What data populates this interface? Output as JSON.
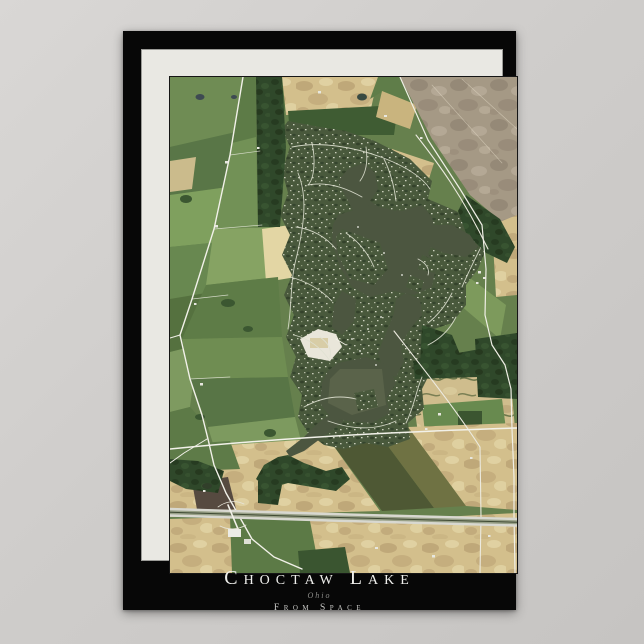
{
  "poster": {
    "title": "Choctaw Lake",
    "subtitle": "Ohio",
    "tagline": "From Space",
    "colors": {
      "page_bg": "#cfcdcb",
      "poster_bg": "#070707",
      "mat": "#e9e8e3",
      "title": "#efefec",
      "subtitle": "#8d8d8a",
      "tagline": "#c9c9c6"
    }
  },
  "map": {
    "description": "satellite view of Choctaw Lake, Ohio",
    "viewbox": "0 0 347 496",
    "palette": {
      "base_green": "#66804d",
      "water": "#4c5640",
      "water_light": "#616a4e",
      "forest": "#2f482a",
      "residential": "#49593c",
      "field_tan": "#d3bf8c",
      "field_gray": "#a59985",
      "field_pale": "#e3d6a4",
      "plowed_olive": "#4e5834",
      "plowed_brown": "#564a40",
      "road": "#f2f1e9",
      "highway_lane": "#d8d8d0",
      "highway_casing": "#98a087",
      "sand": "#e9e6da"
    },
    "layers": [
      {
        "t": "poly",
        "p": "0,0 347,0 347,496 0,496",
        "f": "#66804d"
      },
      {
        "t": "poly",
        "p": "0,0 73,0 66,55 0,70",
        "f": "#6f8c54"
      },
      {
        "t": "poly",
        "p": "0,70 66,55 58,110 0,118",
        "f": "#597647"
      },
      {
        "t": "poly",
        "p": "0,118 58,110 50,165 0,170",
        "f": "#7fa05e"
      },
      {
        "t": "poly",
        "p": "0,170 50,165 42,215 0,222",
        "f": "#688850"
      },
      {
        "t": "poly",
        "p": "0,222 42,215 30,268 0,275",
        "f": "#55713f"
      },
      {
        "t": "poly",
        "p": "0,84 26,80 22,112 0,115",
        "f": "#cbbb8c"
      },
      {
        "t": "poly",
        "p": "0,275 28,268 20,330 0,335",
        "f": "#7e9a60"
      },
      {
        "t": "poly",
        "p": "0,335 20,330 38,350 30,382 0,382",
        "f": "#5d7a47"
      },
      {
        "t": "poly",
        "p": "73,0 86,0 86,62 62,66",
        "f": "#5d7b47"
      },
      {
        "t": "poly",
        "p": "62,66 86,60 88,150 44,152",
        "f": "#729156"
      },
      {
        "t": "poly",
        "p": "44,152 112,150 108,200 36,208",
        "f": "#86a363"
      },
      {
        "t": "poly",
        "p": "92,152 120,148 126,200 96,205",
        "f": "#e3d6a4"
      },
      {
        "t": "poly",
        "p": "36,208 108,200 112,260 12,262",
        "f": "#5e7c47"
      },
      {
        "t": "poly",
        "p": "12,262 112,260 118,300 20,302",
        "f": "#6f8d52"
      },
      {
        "t": "poly",
        "p": "20,302 118,300 125,340 38,350",
        "f": "#587546"
      },
      {
        "t": "poly",
        "p": "38,350 125,340 132,368 55,392 44,370",
        "f": "#7d9a5f"
      },
      {
        "t": "poly",
        "p": "86,0 115,0 118,34 88,36",
        "f": "#54703f"
      },
      {
        "t": "poly",
        "p": "112,0 208,0 200,36 116,38",
        "f": "url(#p-tan)"
      },
      {
        "t": "poly",
        "p": "118,34 228,28 224,58 120,58",
        "f": "#3f5c33"
      },
      {
        "t": "poly",
        "p": "208,0 232,0 247,28 210,16 200,22",
        "f": "#5f7d49"
      },
      {
        "t": "poly",
        "p": "212,14 247,28 240,52 206,40",
        "f": "#c9b47e"
      },
      {
        "t": "poly",
        "p": "230,0 347,0 347,62 262,62",
        "f": "url(#p-gray)"
      },
      {
        "t": "poly",
        "p": "262,62 347,60 347,158 300,118",
        "f": "url(#p-gray)"
      },
      {
        "t": "poly",
        "p": "222,72 264,86 250,130 210,112",
        "f": "url(#p-tan)"
      },
      {
        "t": "poly",
        "p": "322,148 347,138 347,218 326,220",
        "f": "url(#p-tan)"
      },
      {
        "t": "poly",
        "p": "296,198 336,228 330,262 290,228",
        "f": "#7d9a5c"
      },
      {
        "t": "poly",
        "p": "240,300 340,292 345,352 248,356",
        "f": "url(#p-tanhedge)"
      },
      {
        "t": "poly",
        "p": "252,328 332,322 336,352 255,356",
        "f": "#688a4f"
      },
      {
        "t": "rect",
        "x": 288,
        "y": 334,
        "w": 24,
        "h": 14,
        "f": "#3b5530"
      },
      {
        "t": "poly",
        "p": "0,372 158,361 210,434 0,440",
        "f": "url(#p-tan)"
      },
      {
        "t": "poly",
        "p": "0,368 60,364 70,392 20,394 0,392",
        "f": "#5e7b48"
      },
      {
        "t": "poly",
        "p": "158,361 206,353 264,431 212,434",
        "f": "#4e5834"
      },
      {
        "t": "poly",
        "p": "206,353 238,350 296,429 264,431",
        "f": "#6f7243"
      },
      {
        "t": "poly",
        "p": "238,350 347,346 347,433 296,429",
        "f": "url(#p-tan)"
      },
      {
        "t": "poly",
        "p": "22,405 58,400 66,432 28,438",
        "f": "#564a40"
      },
      {
        "t": "poly",
        "p": "0,442 60,440 80,462 62,496 0,496",
        "f": "url(#p-tan)"
      },
      {
        "t": "poly",
        "p": "60,440 140,444 150,496 62,496",
        "f": "#5c7a46"
      },
      {
        "t": "poly",
        "p": "140,444 205,442 208,496 150,496",
        "f": "url(#p-tan)"
      },
      {
        "t": "poly",
        "p": "200,444 347,436 347,496 208,496",
        "f": "url(#p-tan)"
      },
      {
        "t": "poly",
        "p": "128,474 175,470 180,496 130,496",
        "f": "#3a5530"
      },
      {
        "t": "poly",
        "p": "118,44 150,50 176,54 205,64 240,82 262,104 258,122 286,134 312,150 316,172 308,192 296,208 296,228 282,246 264,252 258,272 262,292 252,312 254,332 238,346 240,362 218,370 196,366 174,372 154,368 138,356 128,340 132,318 120,300 126,280 116,260 124,238 114,218 122,198 112,178 120,158 110,138 118,116 112,94 120,70 112,52",
        "f": "url(#p-resid)"
      },
      {
        "t": "poly",
        "p": "86,0 112,0 116,70 110,150 88,150",
        "f": "url(#p-forest)"
      },
      {
        "t": "poly",
        "p": "296,118 330,142 345,170 337,186 316,176 296,156 288,134",
        "f": "url(#p-forest)"
      },
      {
        "t": "poly",
        "p": "252,248 282,258 292,282 270,302 250,288",
        "f": "url(#p-forest)"
      },
      {
        "t": "poly",
        "p": "243,284 310,272 308,300 245,302",
        "f": "url(#p-forest)"
      },
      {
        "t": "poly",
        "p": "305,262 347,256 347,322 308,320",
        "f": "url(#p-forest)"
      },
      {
        "t": "poly",
        "p": "118,378 134,386 156,394 172,390 180,402 166,414 142,410 118,406 98,412 86,402 94,388 108,380",
        "f": "url(#p-forest)"
      },
      {
        "t": "poly",
        "p": "88,404 112,408 108,428 88,426",
        "f": "url(#p-forest)"
      },
      {
        "t": "poly",
        "p": "0,382 28,384 54,394 48,416 16,412 0,404",
        "f": "url(#p-forest)"
      },
      {
        "t": "ellipse",
        "cx": 16,
        "cy": 122,
        "rx": 6,
        "ry": 4,
        "f": "#3b5731"
      },
      {
        "t": "ellipse",
        "cx": 58,
        "cy": 226,
        "rx": 7,
        "ry": 4,
        "f": "#3b5731"
      },
      {
        "t": "ellipse",
        "cx": 78,
        "cy": 252,
        "rx": 5,
        "ry": 3,
        "f": "#3b5731"
      },
      {
        "t": "ellipse",
        "cx": 100,
        "cy": 356,
        "rx": 6,
        "ry": 4,
        "f": "#3b5731"
      },
      {
        "t": "ellipse",
        "cx": 30,
        "cy": 340,
        "rx": 5,
        "ry": 3,
        "f": "#3b5731"
      },
      {
        "t": "ellipse",
        "cx": 30,
        "cy": 20,
        "rx": 4.5,
        "ry": 3,
        "f": "#3e4a52"
      },
      {
        "t": "ellipse",
        "cx": 64,
        "cy": 20,
        "rx": 3,
        "ry": 2,
        "f": "#3e4a52"
      },
      {
        "t": "ellipse",
        "cx": 192,
        "cy": 20,
        "rx": 5,
        "ry": 3.5,
        "f": "#394a42"
      },
      {
        "t": "ellipse",
        "cx": 37,
        "cy": 409,
        "rx": 5,
        "ry": 3,
        "f": "#313f2a"
      },
      {
        "t": "poly",
        "p": "178,92 194,86 205,96 208,112 200,124 212,132 200,142 184,136 176,120 168,104",
        "f": "#4c5640"
      },
      {
        "t": "poly",
        "p": "168,138 200,128 232,134 252,128 262,140 266,160 258,176 266,190 262,210 244,218 224,214 200,220 182,210 170,190 162,165 163,148",
        "f": "#4c5640"
      },
      {
        "t": "poly",
        "p": "258,148 282,148 300,158 308,170 296,180 274,176 256,168",
        "f": "#4c5640"
      },
      {
        "t": "poly",
        "p": "236,216 250,222 252,238 240,252 230,268 234,284 226,300 214,296 208,276 216,256 224,236 226,222",
        "f": "#4c5640"
      },
      {
        "t": "poly",
        "p": "168,286 196,280 218,288 226,306 216,322 220,336 202,346 178,344 160,340 150,326 152,306 158,294",
        "f": "#4c5640"
      },
      {
        "t": "poly",
        "p": "172,214 186,222 184,244 172,258 162,250 164,228",
        "f": "#4c5640"
      },
      {
        "t": "poly",
        "p": "160,338 174,344 150,362 134,374 120,380 116,374 134,360 148,346",
        "f": "#4c5640"
      },
      {
        "t": "poly",
        "p": "170,292 212,292 216,328 182,338 158,326 160,302",
        "f": "#616a4e",
        "o": 0.7
      },
      {
        "t": "poly",
        "p": "172,152 210,166 218,192 204,208 180,202 168,178 166,160",
        "f": "url(#p-resid)"
      },
      {
        "t": "poly",
        "p": "210,112 228,120 226,134 210,130",
        "f": "url(#p-resid)"
      },
      {
        "t": "poly",
        "p": "252,178 268,184 264,196 248,192",
        "f": "url(#p-resid)"
      },
      {
        "t": "poly",
        "p": "240,198 254,204 250,216 236,210",
        "f": "url(#p-resid)"
      },
      {
        "t": "poly",
        "p": "184,316 204,312 208,330 188,334",
        "f": "url(#p-resid)"
      },
      {
        "t": "poly",
        "p": "130,262 148,252 166,257 172,270 160,284 138,280",
        "f": "#e9e6da"
      },
      {
        "t": "rect",
        "x": 140,
        "y": 261,
        "w": 18,
        "h": 10,
        "f": "#d8cda6"
      },
      {
        "t": "path",
        "d": "M166,262 L176,268",
        "f": "#f4f2e8",
        "w": 0.8
      },
      {
        "t": "path",
        "d": "M128,96 C138,120 134,150 126,182 C120,206 122,228 118,252",
        "f": "#dfe1d2",
        "w": 0.9,
        "o": 0.9
      },
      {
        "t": "path",
        "d": "M122,70 C150,64 186,70 216,82 C236,90 252,100 260,112",
        "f": "#dfe1d2",
        "w": 0.9,
        "o": 0.9
      },
      {
        "t": "path",
        "d": "M138,108 C158,104 178,112 192,120",
        "f": "#dfe1d2",
        "w": 0.9,
        "o": 0.9
      },
      {
        "t": "path",
        "d": "M126,150 C142,152 156,160 166,172",
        "f": "#dfe1d2",
        "w": 0.9,
        "o": 0.9
      },
      {
        "t": "path",
        "d": "M120,200 C136,204 150,212 162,224",
        "f": "#dfe1d2",
        "w": 0.9,
        "o": 0.9
      },
      {
        "t": "path",
        "d": "M124,258 C140,262 152,272 160,284",
        "f": "#dfe1d2",
        "w": 0.9,
        "o": 0.9
      },
      {
        "t": "path",
        "d": "M134,330 C152,320 170,318 186,322",
        "f": "#dfe1d2",
        "w": 0.9,
        "o": 0.9
      },
      {
        "t": "path",
        "d": "M158,344 C180,352 204,354 226,344",
        "f": "#dfe1d2",
        "w": 0.9,
        "o": 0.9
      },
      {
        "t": "path",
        "d": "M236,346 C244,330 246,314 252,300",
        "f": "#dfe1d2",
        "w": 0.9,
        "o": 0.9
      },
      {
        "t": "path",
        "d": "M258,268 C270,262 280,252 286,240",
        "f": "#dfe1d2",
        "w": 0.9,
        "o": 0.9
      },
      {
        "t": "path",
        "d": "M292,210 C298,196 304,184 310,172",
        "f": "#dfe1d2",
        "w": 0.9,
        "o": 0.9
      },
      {
        "t": "path",
        "d": "M226,124 C224,108 220,94 214,82",
        "f": "#dfe1d2",
        "w": 0.9,
        "o": 0.9
      },
      {
        "t": "path",
        "d": "M176,156 C188,164 198,176 204,190",
        "f": "#dfe1d2",
        "w": 0.9,
        "o": 0.9
      },
      {
        "t": "path",
        "d": "M248,182 C256,186 260,192 258,198",
        "f": "#dfe1d2",
        "w": 0.9,
        "o": 0.9
      },
      {
        "t": "path",
        "d": "M150,260 C158,266 162,272 160,280",
        "f": "#dfe1d2",
        "w": 0.9,
        "o": 0.9
      },
      {
        "t": "path",
        "d": "M142,66 C146,84 144,102 138,108",
        "f": "#dfe1d2",
        "w": 0.9,
        "o": 0.9
      },
      {
        "t": "path",
        "d": "M196,70 C198,84 196,96 190,104",
        "f": "#dfe1d2",
        "w": 0.9,
        "o": 0.9
      },
      {
        "t": "path",
        "d": "M282,216 C276,228 268,238 258,246",
        "f": "#dfe1d2",
        "w": 0.9,
        "o": 0.9
      },
      {
        "t": "path",
        "d": "M246,58 C268,86 292,118 318,172",
        "f": "#eceadf",
        "w": 1.1
      },
      {
        "t": "path",
        "d": "M73,0 L60,78 L44,152 L22,222 L10,258 L20,302 L32,338 L38,362 L44,388 L56,416 L64,430 L82,462 L104,480 L132,492",
        "f": "#f2f1e9",
        "w": 1.4
      },
      {
        "t": "path",
        "d": "M10,258 L0,261",
        "f": "#f2f1e9",
        "w": 1
      },
      {
        "t": "path",
        "d": "M37,362 L14,376 L0,386",
        "f": "#f2f1e9",
        "w": 1
      },
      {
        "t": "path",
        "d": "M230,0 L258,63 L290,112 L312,148 L316,192 L315,238 L322,268 L335,288 L341,312 L342,352 L344,400 L344,438 L345,496",
        "f": "#f0efe6",
        "w": 1.2
      },
      {
        "t": "path",
        "d": "M224,254 C252,290 284,330 310,370 L311,440 L310,496",
        "f": "#eceadf",
        "w": 1.1
      },
      {
        "t": "path",
        "d": "M0,372 C60,366 140,360 220,356 C262,354 310,352 347,351",
        "f": "#f2f1e9",
        "w": 1.5
      },
      {
        "t": "path",
        "d": "M262,8 L332,86",
        "f": "#e3dbc6",
        "w": 0.7,
        "o": 0.55
      },
      {
        "t": "path",
        "d": "M292,2 L347,52",
        "f": "#e3dbc6",
        "w": 0.7,
        "o": 0.55
      },
      {
        "t": "path",
        "d": "M60,78 L90,74",
        "f": "#eeeee4",
        "w": 0.7,
        "o": 0.8
      },
      {
        "t": "path",
        "d": "M44,152 L92,148",
        "f": "#eeeee4",
        "w": 0.7,
        "o": 0.8
      },
      {
        "t": "path",
        "d": "M22,222 L58,218",
        "f": "#eeeee4",
        "w": 0.7,
        "o": 0.8
      },
      {
        "t": "path",
        "d": "M20,302 L60,300",
        "f": "#eeeee4",
        "w": 0.7,
        "o": 0.8
      },
      {
        "t": "path",
        "d": "M0,435 L160,440 L347,445",
        "f": "#98a087",
        "w": 8
      },
      {
        "t": "path",
        "d": "M0,432 L160,437 L347,442",
        "f": "#d8d8d0",
        "w": 2.4
      },
      {
        "t": "path",
        "d": "M0,438.5 L160,443.5 L347,448.5",
        "f": "#d8d8d0",
        "w": 2.4
      },
      {
        "t": "path",
        "d": "M0,435.2 L160,440.2 L347,445.2",
        "f": "#3f4a33",
        "w": 1
      },
      {
        "t": "path",
        "d": "M58,428 L68,452",
        "f": "#f2f1e9",
        "w": 1.6
      },
      {
        "t": "path",
        "d": "M48,430 C56,424 66,423 74,427",
        "f": "#e6e4d8",
        "w": 0.8
      },
      {
        "t": "path",
        "d": "M50,449 C58,453 68,453 76,448",
        "f": "#e6e4d8",
        "w": 0.8
      },
      {
        "t": "rect",
        "x": 58,
        "y": 452,
        "w": 13,
        "h": 8,
        "f": "#ecece6"
      },
      {
        "t": "rect",
        "x": 74,
        "y": 462,
        "w": 7,
        "h": 5,
        "f": "#dedfd6"
      },
      {
        "t": "rect",
        "x": 55,
        "y": 84,
        "w": 3,
        "h": 2.5,
        "f": "#e7e7df"
      },
      {
        "t": "rect",
        "x": 45,
        "y": 148,
        "w": 3,
        "h": 2.5,
        "f": "#e7e7df"
      },
      {
        "t": "rect",
        "x": 87,
        "y": 70,
        "w": 2.5,
        "h": 2,
        "f": "#e7e7df"
      },
      {
        "t": "rect",
        "x": 148,
        "y": 14,
        "w": 3,
        "h": 2.5,
        "f": "#e7e7df"
      },
      {
        "t": "rect",
        "x": 214,
        "y": 38,
        "w": 3,
        "h": 2,
        "f": "#e7e7df"
      },
      {
        "t": "rect",
        "x": 250,
        "y": 60,
        "w": 2.5,
        "h": 2,
        "f": "#e7e7df"
      },
      {
        "t": "rect",
        "x": 308,
        "y": 194,
        "w": 3,
        "h": 2.5,
        "f": "#e7e7df"
      },
      {
        "t": "rect",
        "x": 313,
        "y": 200,
        "w": 2.5,
        "h": 2,
        "f": "#e7e7df"
      },
      {
        "t": "rect",
        "x": 306,
        "y": 205,
        "w": 2.5,
        "h": 2,
        "f": "#e7e7df"
      },
      {
        "t": "rect",
        "x": 268,
        "y": 336,
        "w": 3,
        "h": 2.5,
        "f": "#e7e7df"
      },
      {
        "t": "rect",
        "x": 255,
        "y": 351,
        "w": 2.5,
        "h": 2,
        "f": "#e7e7df"
      },
      {
        "t": "rect",
        "x": 300,
        "y": 380,
        "w": 2.5,
        "h": 2,
        "f": "#e7e7df"
      },
      {
        "t": "rect",
        "x": 33,
        "y": 413,
        "w": 2.5,
        "h": 2,
        "f": "#e7e7df"
      },
      {
        "t": "rect",
        "x": 205,
        "y": 470,
        "w": 3,
        "h": 2,
        "f": "#e7e7df"
      },
      {
        "t": "rect",
        "x": 262,
        "y": 478,
        "w": 3,
        "h": 2.5,
        "f": "#e7e7df"
      },
      {
        "t": "rect",
        "x": 318,
        "y": 458,
        "w": 2.5,
        "h": 2,
        "f": "#e7e7df"
      },
      {
        "t": "rect",
        "x": 30,
        "y": 306,
        "w": 3,
        "h": 2.5,
        "f": "#e7e7df"
      },
      {
        "t": "rect",
        "x": 24,
        "y": 226,
        "w": 2.5,
        "h": 2,
        "f": "#e7e7df"
      },
      {
        "t": "dot",
        "cx": 182,
        "cy": 262,
        "r": 0.9,
        "f": "#f2f2ea"
      },
      {
        "t": "dot",
        "cx": 190,
        "cy": 274,
        "r": 0.9,
        "f": "#f2f2ea"
      },
      {
        "t": "dot",
        "cx": 198,
        "cy": 252,
        "r": 0.9,
        "f": "#f2f2ea"
      },
      {
        "t": "dot",
        "cx": 206,
        "cy": 288,
        "r": 0.9,
        "f": "#f2f2ea"
      },
      {
        "t": "dot",
        "cx": 188,
        "cy": 150,
        "r": 0.9,
        "f": "#f2f2ea"
      },
      {
        "t": "dot",
        "cx": 214,
        "cy": 176,
        "r": 0.9,
        "f": "#f2f2ea"
      },
      {
        "t": "dot",
        "cx": 232,
        "cy": 198,
        "r": 0.9,
        "f": "#f2f2ea"
      },
      {
        "t": "dot",
        "cx": 211,
        "cy": 240,
        "r": 0.9,
        "f": "#f2f2ea"
      }
    ]
  }
}
